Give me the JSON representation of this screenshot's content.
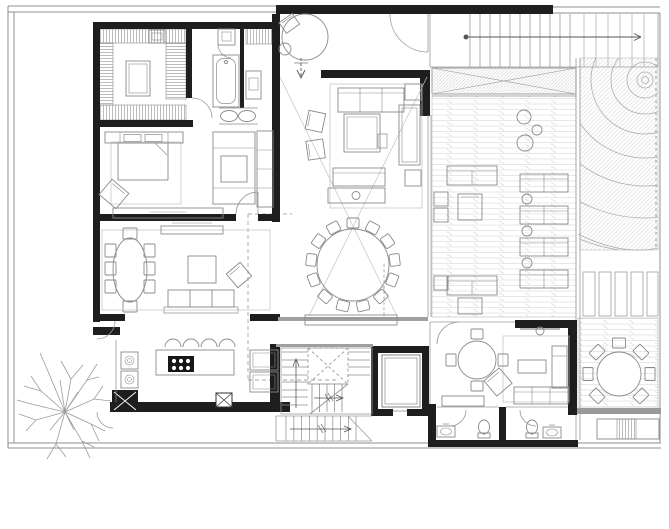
{
  "canvas": {
    "width": 669,
    "height": 529,
    "background": "#ffffff"
  },
  "drawing": {
    "kind": "residential-floor-plan",
    "text_labels": []
  },
  "colors": {
    "wall": "#1e1e1e",
    "wall_gray": "#9a9a9a",
    "boundary": "#8f8f8f",
    "line": "#6e6e6e",
    "furniture": "#8a8a8a",
    "light": "#b0b0b0",
    "hatch": "#c9c9c9",
    "door": "#9a9a9a",
    "background": "#ffffff"
  },
  "regions": [
    {
      "name": "walk-in-closet",
      "features": [
        "wardrobe-runs",
        "center-island",
        "bench"
      ]
    },
    {
      "name": "master-bathroom",
      "features": [
        "bathtub",
        "shower",
        "double-vanity-sinks",
        "wall-vanity",
        "louver-screen"
      ]
    },
    {
      "name": "entry-vestibule",
      "features": [
        "round-planter-table",
        "accent-chair",
        "entry-door",
        "entry-arrow"
      ]
    },
    {
      "name": "exterior-side-stair",
      "features": [
        "treads",
        "direction-arrow"
      ]
    },
    {
      "name": "double-height-living-room",
      "features": [
        "sofa",
        "two-armchairs",
        "coffee-table",
        "daybed",
        "console-with-lamp",
        "side-tables",
        "void-cross-lines"
      ]
    },
    {
      "name": "dining-hall",
      "features": [
        "round-table-13-chairs",
        "sideboard-console"
      ]
    },
    {
      "name": "master-bedroom",
      "features": [
        "double-bed",
        "headboard-nightstands",
        "armchair",
        "low-dresser",
        "rug"
      ]
    },
    {
      "name": "study-lounge",
      "features": [
        "chaise-sofa",
        "ottoman",
        "wall-shelf"
      ]
    },
    {
      "name": "family-dining-room",
      "features": [
        "oval-table-8-chairs",
        "sofa",
        "coffee-table",
        "armchair",
        "sideboard",
        "rug"
      ]
    },
    {
      "name": "kitchen",
      "features": [
        "island-with-cooktop",
        "four-bar-stools",
        "double-wall-ovens",
        "refrigerator-units",
        "service-columns"
      ]
    },
    {
      "name": "main-staircase",
      "features": [
        "u-shaped-flights",
        "landing",
        "direction-arrows"
      ]
    },
    {
      "name": "elevator",
      "features": [
        "car-outline"
      ]
    },
    {
      "name": "exterior-lower-stair",
      "features": [
        "treads",
        "direction-arrow"
      ]
    },
    {
      "name": "family-room",
      "features": [
        "round-table-4-chairs",
        "sofa",
        "chaise",
        "coffee-table",
        "armchair",
        "tv-bar",
        "console",
        "rug"
      ]
    },
    {
      "name": "powder-room-1",
      "features": [
        "toilet",
        "sink"
      ]
    },
    {
      "name": "powder-room-2",
      "features": [
        "toilet",
        "sink"
      ]
    },
    {
      "name": "wood-deck-lounge",
      "features": [
        "plank-decking",
        "outdoor-sofas",
        "double-loungers",
        "round-side-tables",
        "side-cubes",
        "armchairs"
      ]
    },
    {
      "name": "zen-garden",
      "features": [
        "raked-gravel-arcs",
        "diagonal-groundcover-hatch"
      ]
    },
    {
      "name": "stepping-pavers",
      "features": [
        "five-slabs"
      ]
    },
    {
      "name": "outdoor-dining-terrace",
      "features": [
        "round-table-8-chairs",
        "planter-bench",
        "step-edge"
      ]
    },
    {
      "name": "landscape",
      "features": [
        "deciduous-tree"
      ]
    },
    {
      "name": "site",
      "features": [
        "property-boundary",
        "setback-dashed-lines"
      ]
    }
  ]
}
